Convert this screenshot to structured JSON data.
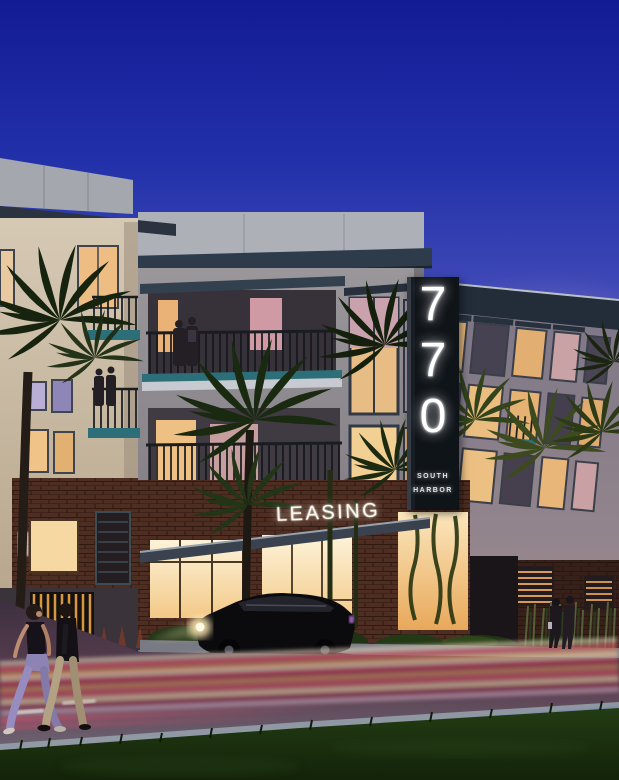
{
  "image": {
    "kind": "architectural-rendering-dusk",
    "subject": "770 South Harbor apartment community exterior at dusk with illuminated leasing entrance, palm trees, parked black sedan, traffic light trails and pedestrians"
  },
  "signs": {
    "pylon": {
      "digits": [
        "7",
        "7",
        "0"
      ],
      "line1": "SOUTH",
      "line2": "HARBOR"
    },
    "leasing_label": "LEASING"
  },
  "palette": {
    "sky_top": "#131b94",
    "sky_mid": "#3d47b5",
    "sky_horizon": "#cbadda",
    "parapet_gray": "#adb0b6",
    "cornice_dark": "#2e3b4b",
    "facade_gray": "#908d90",
    "facade_cream": "#cabfae",
    "brick": "#4e2d22",
    "window_glow": "#f2c47e",
    "storefront_glow": "#fbe7bd",
    "balcony_teal": "#2d6f78",
    "sign_panel": "#0f1419",
    "sign_text": "#ffffff",
    "palm_dark": "#16230e",
    "palm_lit": "#3c4a1e",
    "asphalt": "#573c4d",
    "trail_red": "#b8485c",
    "trail_amber": "#e0a05c",
    "trail_white": "#f0d8b8",
    "grass": "#1c3413"
  }
}
